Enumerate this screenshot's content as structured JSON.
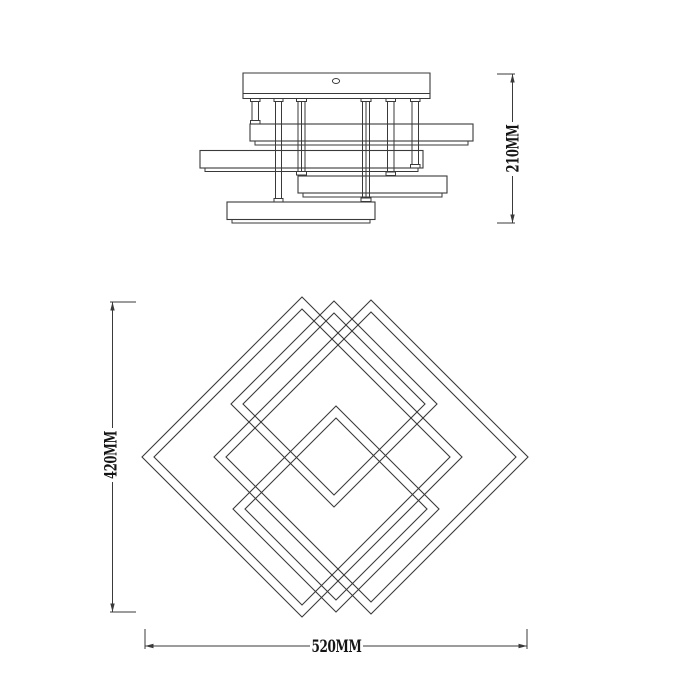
{
  "drawing": {
    "background": "#ffffff",
    "line_color": "#3a3a3a",
    "side_view": {
      "height_dimension_label": "210MM"
    },
    "plan_view": {
      "height_dimension_label": "420MM",
      "width_dimension_label": "520MM"
    }
  }
}
